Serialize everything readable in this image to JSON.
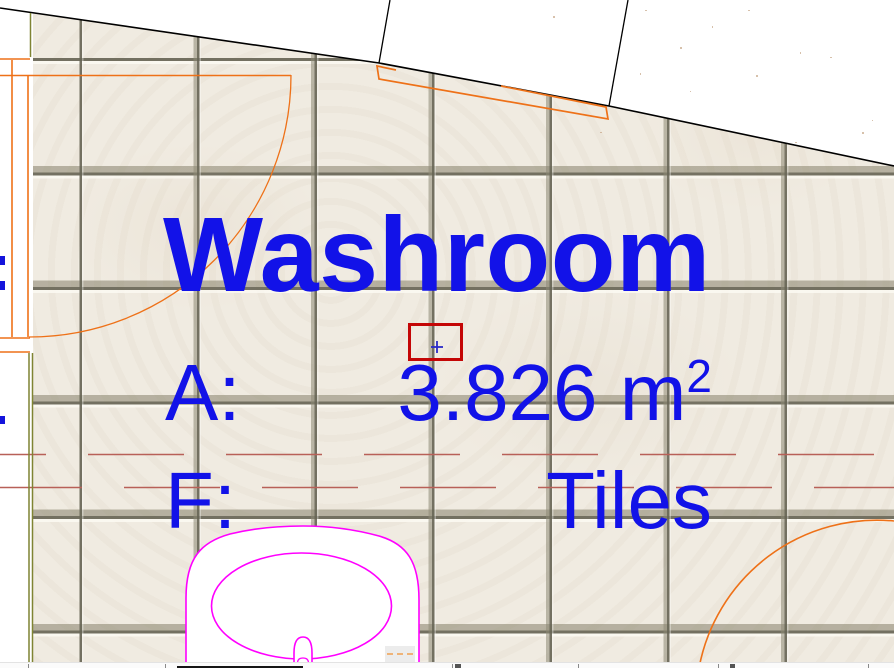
{
  "app": {
    "view": "floor-plan-canvas",
    "description": "CAD floor plan zoomed to washroom zone stamp"
  },
  "room_stamp": {
    "name": "Washroom",
    "area_label": "A:",
    "area_value": "3.826 m",
    "area_exponent": "2",
    "finish_label": "F:",
    "finish_value": "Tiles"
  },
  "cursor": {
    "marker_glyph": "+",
    "selection_rectangle": {
      "x": 408,
      "y": 323,
      "width": 55,
      "height": 38
    }
  },
  "colors": {
    "stamp_text_blue": "#1212e8",
    "selection_red": "#c40606",
    "door_window_orange": "#ee7118",
    "fixture_magenta": "#ff00ff",
    "hidden_line_red": "#b86058",
    "wall_edge_olive": "#7f8433",
    "wall_line_black": "#000000",
    "tile_base": "#f0ebe1",
    "grout": "#686656"
  }
}
